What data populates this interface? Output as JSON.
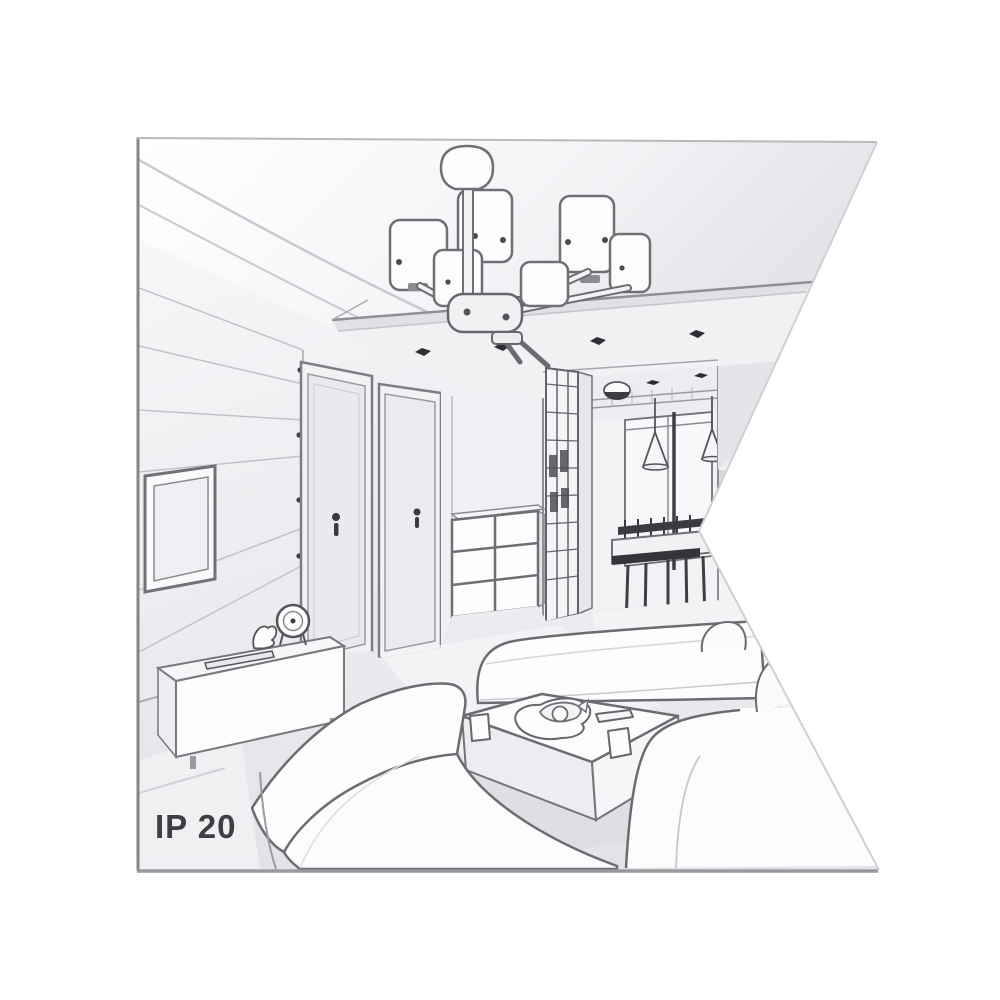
{
  "illustration": {
    "type": "interior-living-room-line-art",
    "label": "IP 20",
    "palette": {
      "background": "#ffffff",
      "line": "#6b6b71",
      "line_dark": "#2e2e33",
      "ceiling_shade": "#d6d6db",
      "wall": "#f2f2f5",
      "wall_shadow": "#d7d7dd",
      "floor": "#e8e8ed",
      "furniture_fill": "#fdfdfe",
      "label_color": "#3e3e43"
    },
    "scene_objects": [
      "chandelier-6-shades",
      "ceiling-recessed-panel",
      "ceiling-spotlights",
      "tv-wall-panels",
      "wall-tv",
      "tv-sideboard",
      "table-clock",
      "figurine",
      "remote-control",
      "door-left",
      "door-right",
      "drawer-chest",
      "glazed-cabinet",
      "hallway",
      "hall-ceiling-light",
      "pendant-cone-lights",
      "dining-table-and-chairs",
      "back-window",
      "sofa-left",
      "ottoman-sofa",
      "sofa-right",
      "coffee-table",
      "plate-with-food",
      "cups",
      "tray"
    ]
  }
}
